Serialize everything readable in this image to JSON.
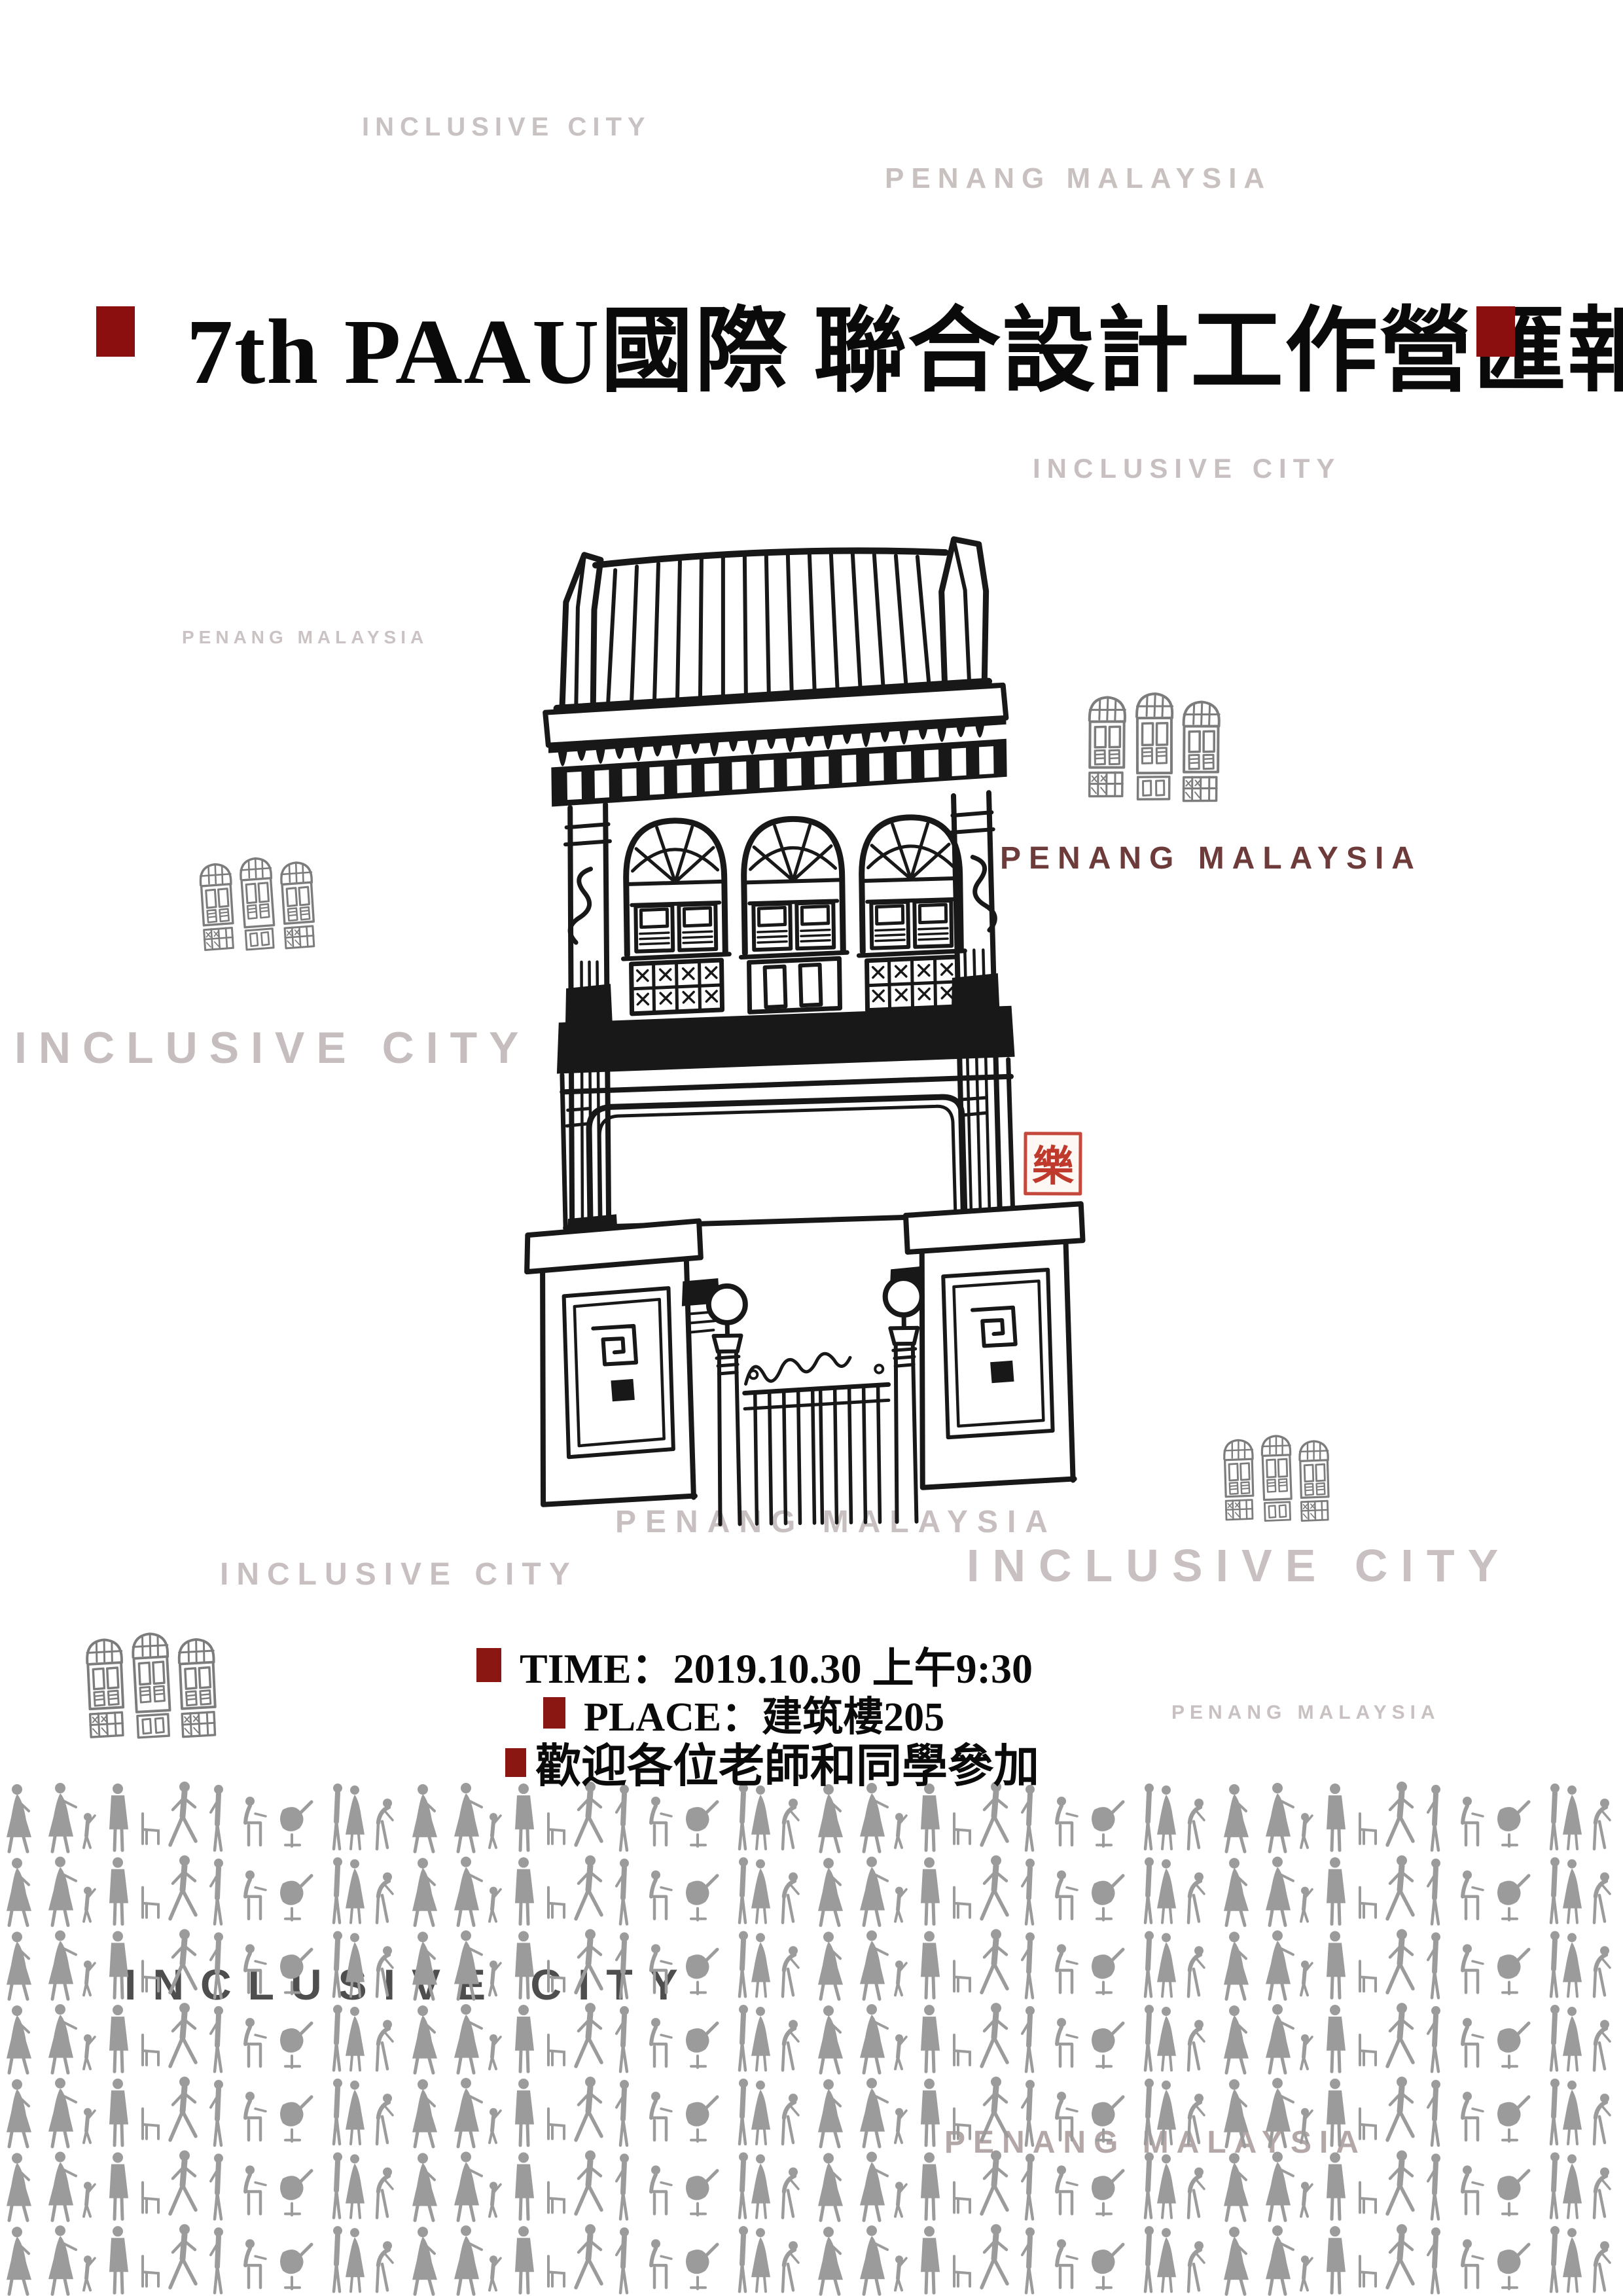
{
  "poster": {
    "title": {
      "text": "7th PAAU國際 聯合設計工作營匯報"
    },
    "watermarks": {
      "inclusive_city": "INCLUSIVE CITY",
      "penang_malaysia": "PENANG MALAYSIA"
    },
    "highlight": {
      "penang_malaysia_red": "PENANG MALAYSIA"
    },
    "seal": {
      "character": "樂"
    },
    "event_details": [
      {
        "text": "TIME：2019.10.30 上午9:30"
      },
      {
        "text": "PLACE：建筑樓205"
      },
      {
        "text": "歡迎各位老師和同學參加"
      }
    ],
    "colors": {
      "accent_dark_red": "#8b0f0f",
      "bullet_red": "#8b1712",
      "maroon_text": "#6e3b3b",
      "watermark_gray": "#c7bfbf",
      "crowd_overlay_dark": "#4e4e4e",
      "crowd_gray": "#9b9b9b",
      "seal_red": "#bf3a2d",
      "ink": "#181818"
    },
    "icons": {
      "window_stamp": "three-shophouse-windows-icon",
      "building": "penang-shophouse-illustration",
      "crowd": "people-silhouettes-pattern"
    }
  }
}
